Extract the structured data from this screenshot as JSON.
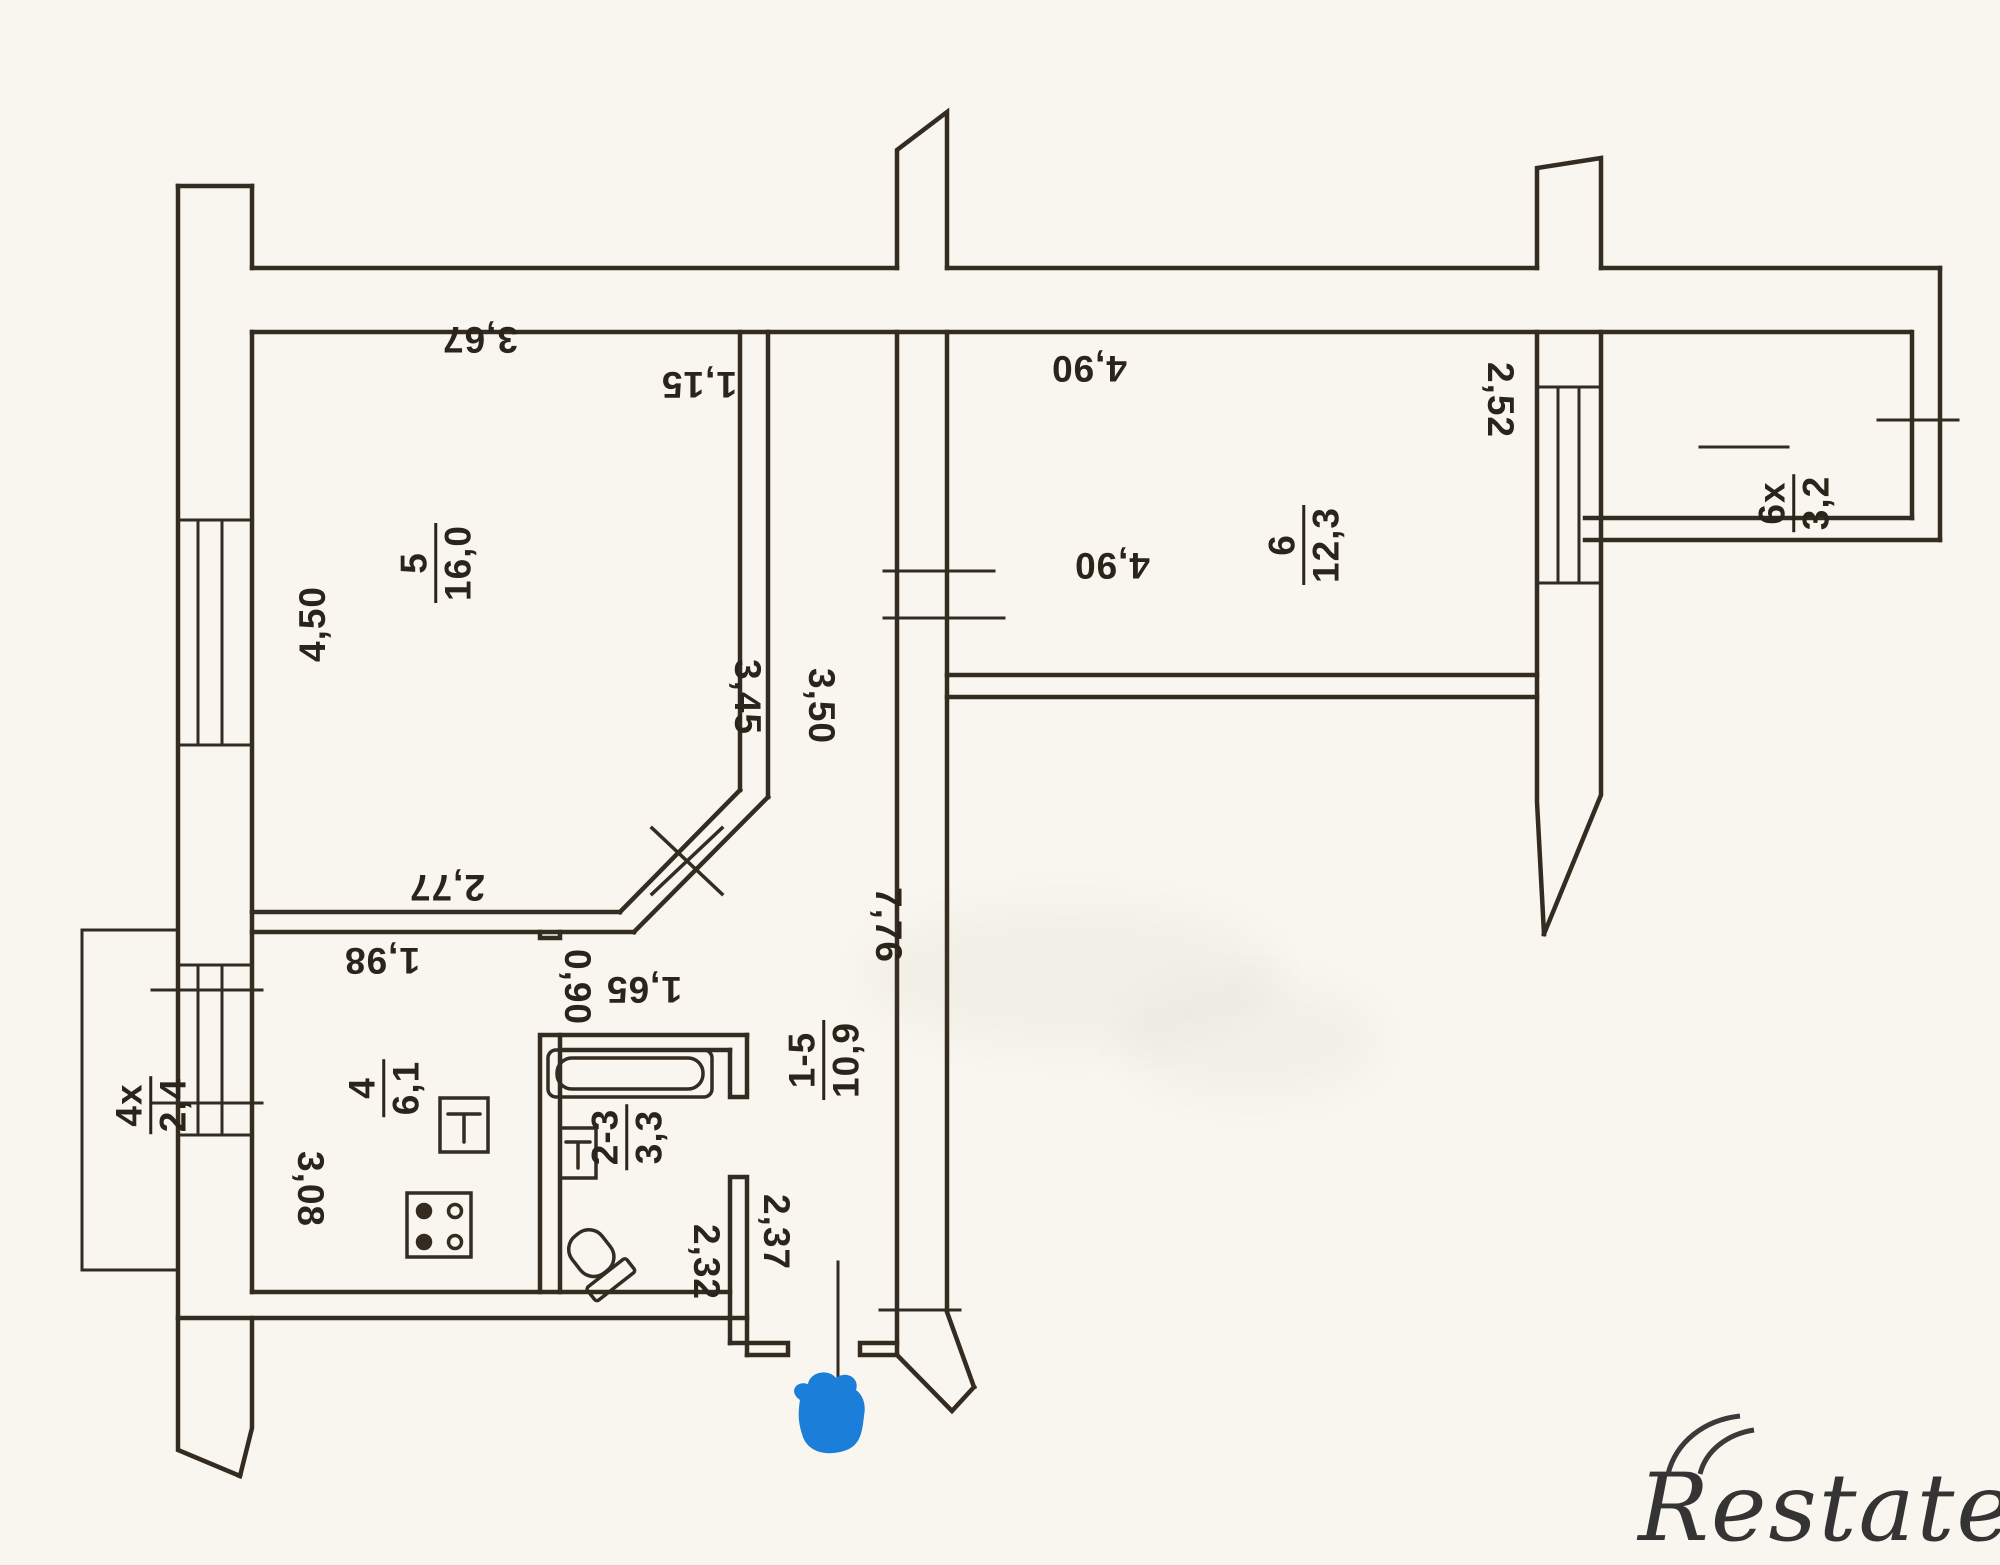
{
  "document": {
    "kind": "apartment floor plan scan",
    "watermark_brand": "Restate"
  },
  "colors": {
    "paper": "#f8f6ee",
    "ink": "#342c21",
    "entrance_marker_blue": "#1b7ed8",
    "watermark_gray": "#343434"
  },
  "rooms": {
    "living": {
      "num": "5",
      "area": "16,0"
    },
    "bedroom": {
      "num": "6",
      "area": "12,3"
    },
    "kitchen": {
      "num": "4",
      "area": "6,1"
    },
    "bath": {
      "num": "2-3",
      "area": "3,3"
    },
    "hall": {
      "num": "1-5",
      "area": "10,9"
    },
    "balcony_left": {
      "num": "4x",
      "area": "2,4"
    },
    "balcony_right": {
      "num": "6x",
      "area": "3,2"
    }
  },
  "dims": {
    "room5_width": "3,67",
    "room5_height": "4,50",
    "room5_right": "3,45",
    "room5_bottom": "2,77",
    "corridor_width": "1,15",
    "corridor_height": "3,50",
    "room6_width_top": "4,90",
    "room6_width_bottom": "4,90",
    "room6_height": "2,52",
    "hall_right_height": "7,76",
    "hall_lower_height": "2,37",
    "kitchen_width": "1,98",
    "kitchen_height": "3,08",
    "kitchen_door": "0,90",
    "bath_width": "1,65",
    "bath_height": "2,32"
  }
}
